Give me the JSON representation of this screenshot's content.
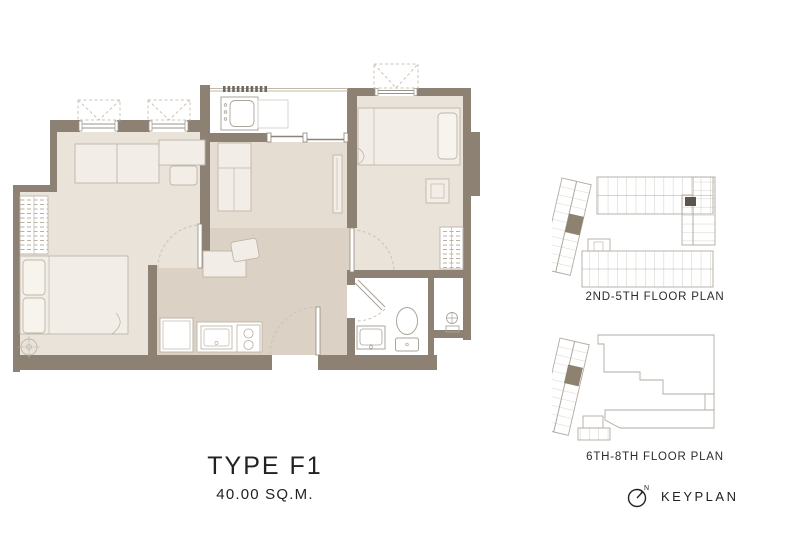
{
  "unit_plan": {
    "type_label": "TYPE F1",
    "area_label": "40.00 SQ.M."
  },
  "keyplans": {
    "plan_2nd_5th_label": "2ND-5TH FLOOR PLAN",
    "plan_6th_8th_label": "6TH-8TH FLOOR PLAN",
    "keyplan_label": "KEYPLAN",
    "compass_north_label": "N"
  },
  "colors": {
    "wall": "#8c8173",
    "floor_light": "#eae3da",
    "floor_mid": "#e5ddd2",
    "floor_dark": "#dbd1c5",
    "furniture": "#f2ede6",
    "furniture_line": "#bfb6a9",
    "fixture_line": "#aba49b",
    "dash_line": "#ccc3b6",
    "keyplan_line": "#b2aba1",
    "highlight_unit": "#8d8170",
    "text": "#212121"
  }
}
